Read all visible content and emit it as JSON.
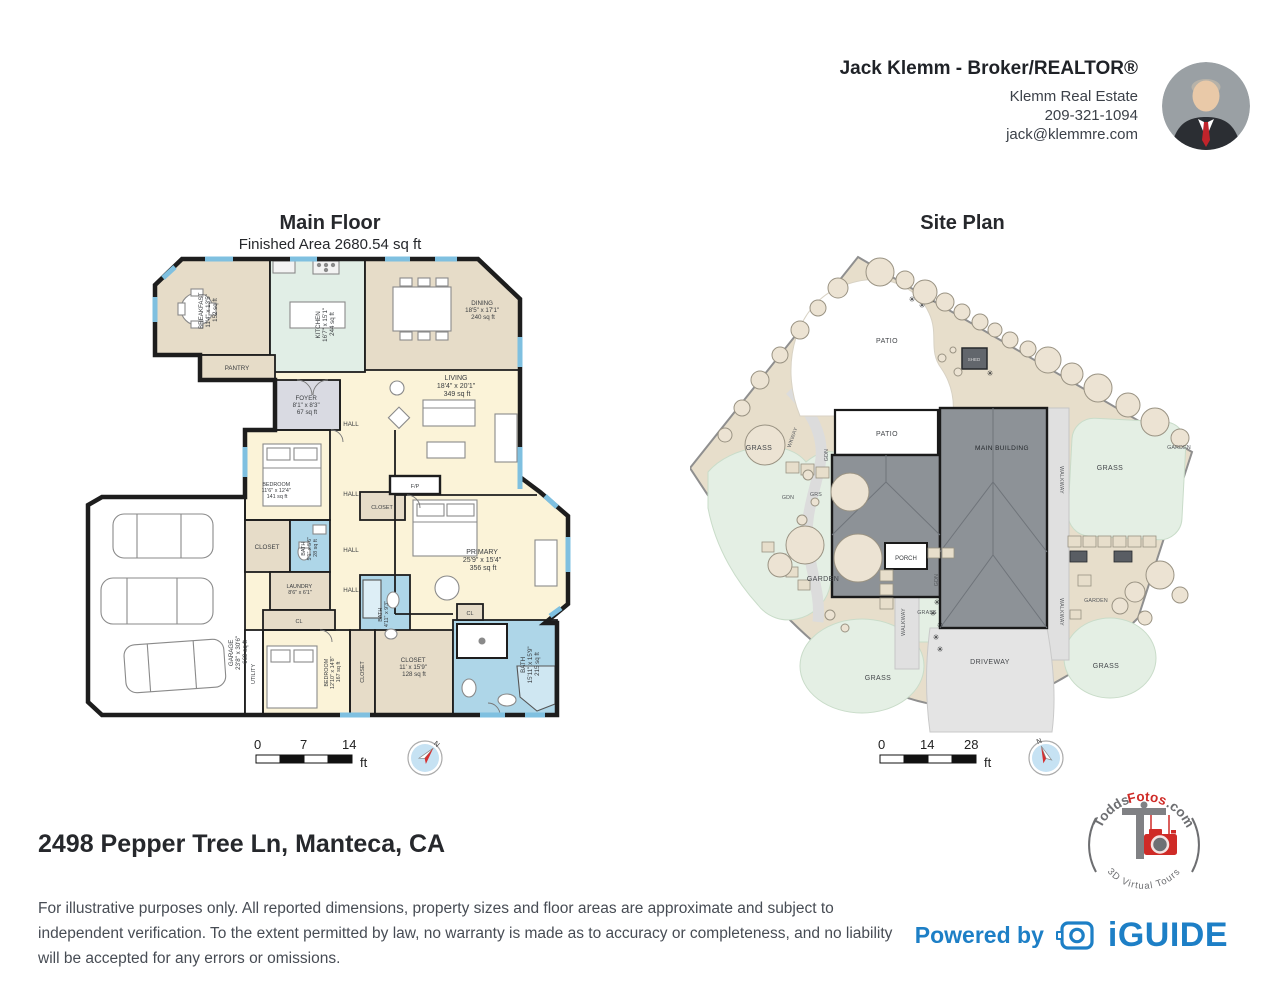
{
  "agent": {
    "name": "Jack Klemm - Broker/REALTOR®",
    "company": "Klemm Real Estate",
    "phone": "209-321-1094",
    "email": "jack@klemmre.com"
  },
  "main_floor": {
    "title": "Main Floor",
    "subtitle": "Finished Area 2680.54 sq ft",
    "scale": {
      "t0": "0",
      "t1": "7",
      "t2": "14",
      "unit": "ft"
    },
    "compass_n": "N",
    "rooms": {
      "breakfast": {
        "name": "BREAKFAST",
        "dims": "11'4\" x 13'5\"",
        "area": "152 sq ft"
      },
      "kitchen": {
        "name": "KITCHEN",
        "dims": "16'7\" x 15'1\"",
        "area": "244 sq ft"
      },
      "dining": {
        "name": "DINING",
        "dims": "18'5\" x 17'1\"",
        "area": "240 sq ft"
      },
      "living": {
        "name": "LIVING",
        "dims": "18'4\" x 20'1\"",
        "area": "349 sq ft"
      },
      "pantry": {
        "name": "PANTRY"
      },
      "foyer": {
        "name": "FOYER",
        "dims": "8'1\" x 8'3\"",
        "area": "67 sq ft"
      },
      "hall": {
        "name": "HALL"
      },
      "bedroom1": {
        "name": "BEDROOM",
        "dims": "11'6\" x 12'4\"",
        "area": "141 sq ft"
      },
      "closet": {
        "name": "CLOSET"
      },
      "fp": {
        "name": "F/P"
      },
      "bath1": {
        "name": "BATH",
        "dims": "5'1\" x 5'6\"",
        "area": "28 sq ft"
      },
      "laundry": {
        "name": "LAUNDRY",
        "dims": "8'6\" x 6'1\""
      },
      "cl": {
        "name": "CL"
      },
      "primary": {
        "name": "PRIMARY",
        "dims": "25'9\" x 15'4\"",
        "area": "356 sq ft"
      },
      "bath2": {
        "name": "BATH",
        "dims": "4'11\" x 9'3\""
      },
      "garage": {
        "name": "GARAGE",
        "dims": "23'8\" x 30'6\"",
        "area": "669 sq ft"
      },
      "utility": {
        "name": "UTILITY"
      },
      "bedroom2": {
        "name": "BEDROOM",
        "dims": "12'10\" x 14'8\"",
        "area": "167 sq ft"
      },
      "closet2": {
        "name": "CLOSET",
        "dims": "11' x 15'9\"",
        "area": "128 sq ft"
      },
      "bath3": {
        "name": "BATH",
        "dims": "15'11\" x 15'9\"",
        "area": "215 sq ft"
      }
    }
  },
  "site_plan": {
    "title": "Site Plan",
    "scale": {
      "t0": "0",
      "t1": "14",
      "t2": "28",
      "unit": "ft"
    },
    "compass_n": "N",
    "labels": {
      "patio": "PATIO",
      "shed": "SHED",
      "main_building": "MAIN BUILDING",
      "porch": "PORCH",
      "driveway": "DRIVEWAY",
      "walkway": "WALKWAY",
      "grass": "GRASS",
      "garden": "GARDEN",
      "gdn": "GDN",
      "grs": "GRS",
      "wkway": "WKWAY"
    }
  },
  "footer": {
    "address": "2498 Pepper Tree Ln, Manteca, CA",
    "disclaimer": "For illustrative purposes only. All reported dimensions, property sizes and floor areas are approximate and subject to independent verification. To the extent permitted by law, no warranty is made as to accuracy or completeness, and no liability will be accepted for any errors or omissions.",
    "powered_by": "Powered by",
    "brand": "iGUIDE"
  },
  "todds_logo": {
    "part1": "Todds",
    "part2": "Fotos",
    "part3": ".com",
    "tagline": "3D Virtual Tours"
  },
  "colors": {
    "accent_blue": "#1d7fc6",
    "logo_red": "#cf2b27",
    "bath_blue": "#aed6e8",
    "room_cream": "#fbf3d8",
    "room_tan": "#e6dcc8",
    "kitchen_mint": "#e1eee6",
    "grass_green": "#e4efe4"
  }
}
